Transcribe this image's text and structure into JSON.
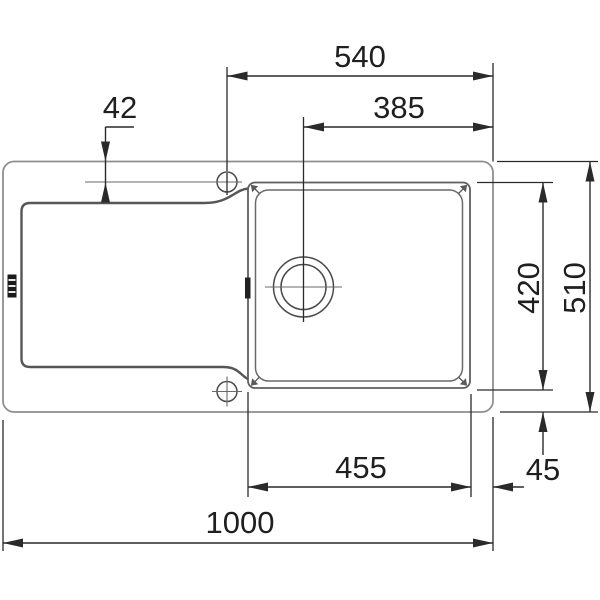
{
  "dimensions": {
    "tap_hole_to_right_edge": "540",
    "drain_to_right_edge": "385",
    "tap_hole_from_top_edge": "42",
    "bowl_depth": "420",
    "overall_depth": "510",
    "bowl_width": "455",
    "bowl_to_edge_gap": "45",
    "overall_width": "1000"
  },
  "colors": {
    "background": "#ffffff",
    "sink_outline": "#8f8f8f",
    "body_lines": "#5f5f5f",
    "dimension_lines": "#2a2a2a",
    "label_text": "#1f1f1f"
  }
}
